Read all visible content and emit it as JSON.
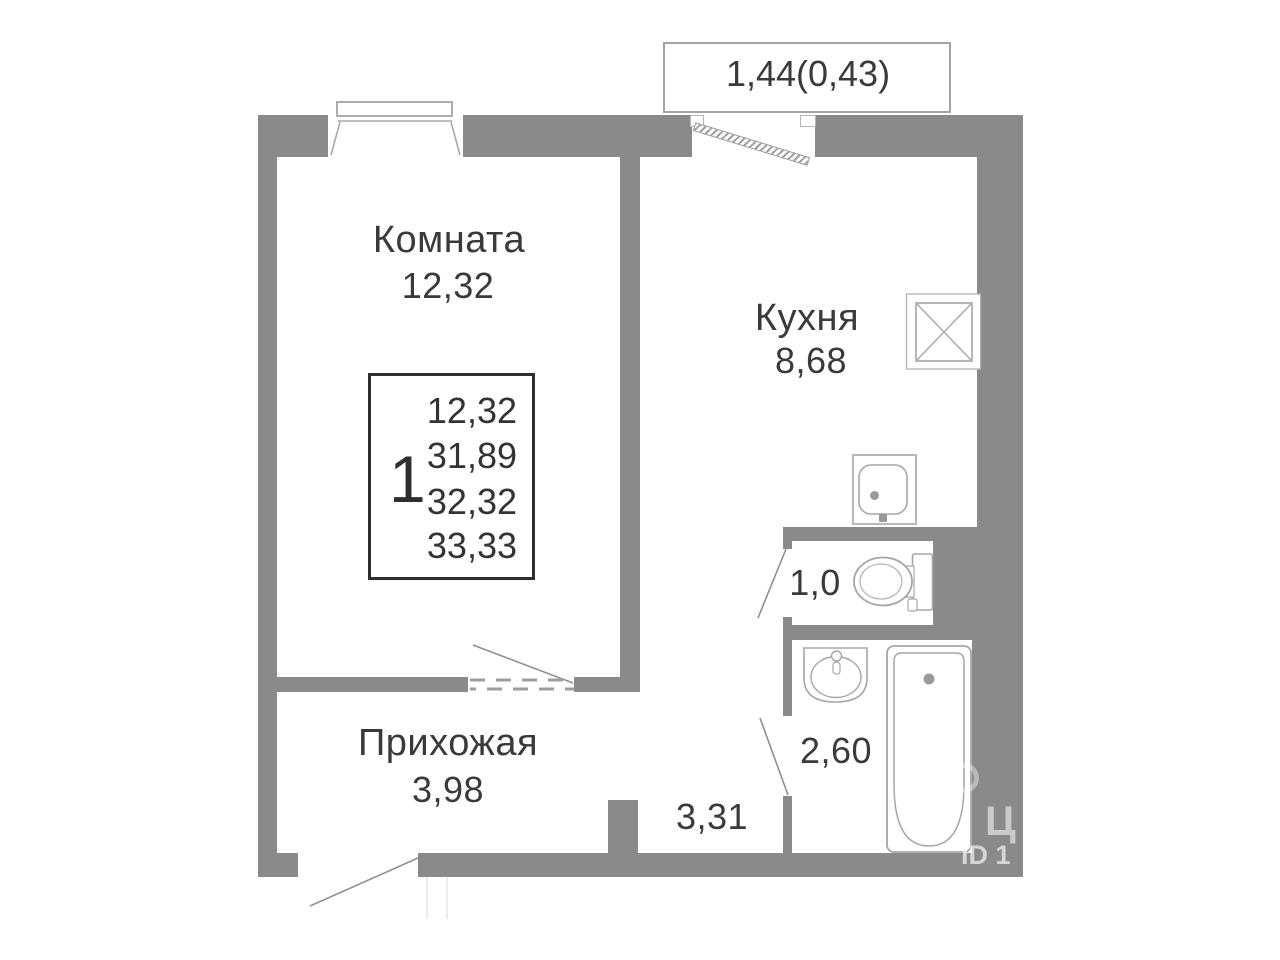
{
  "plan": {
    "balcony": {
      "label": "1,44(0,43)"
    },
    "rooms": [
      {
        "id": "room",
        "name": "Комната",
        "area": "12,32"
      },
      {
        "id": "kitchen",
        "name": "Кухня",
        "area": "8,68"
      },
      {
        "id": "hallway",
        "name": "Прихожая",
        "area": "3,98"
      },
      {
        "id": "wc",
        "name": "",
        "area": "1,0"
      },
      {
        "id": "bathroom",
        "name": "",
        "area": "2,60"
      },
      {
        "id": "corridor",
        "name": "",
        "area": "3,31"
      }
    ],
    "info_box": {
      "rooms_count": "1",
      "values": [
        "12,32",
        "31,89",
        "32,32",
        "33,33"
      ]
    },
    "fixtures": [
      "stove-icon",
      "kitchen-sink-icon",
      "toilet-icon",
      "washbasin-icon",
      "bathtub-icon"
    ],
    "watermark": {
      "name": "ЦИАН",
      "id_text": "ID 1"
    },
    "colors": {
      "wall": "#8a8a8a",
      "fixture_line": "#a6a6a6",
      "text": "#3a3a3a"
    }
  }
}
